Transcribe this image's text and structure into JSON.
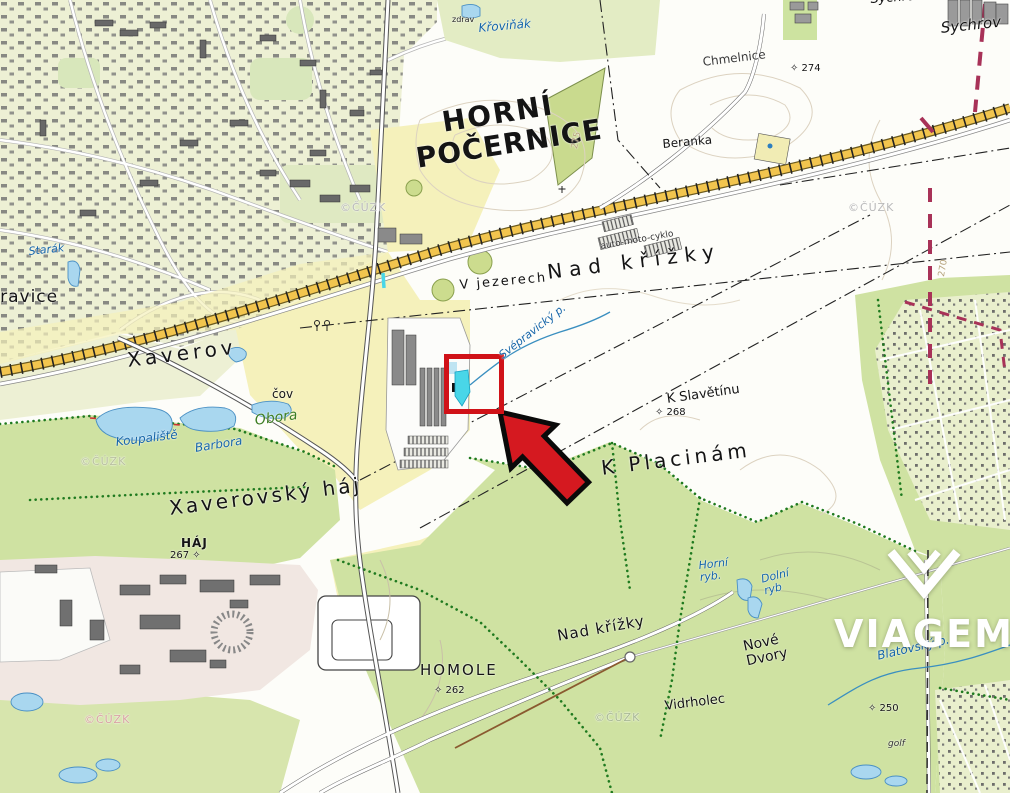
{
  "brand": {
    "watermark_text": "VIAGEM"
  },
  "colors": {
    "highlight_red": "#d01218",
    "arrow_red": "#d51920",
    "water": "#a9d7ef",
    "water_highlight": "#49d6e8",
    "forest": "#cfe2a2",
    "field": "#f5f1bb",
    "urban_base": "#edf0d4",
    "railway": "#f2c54e",
    "boundary_magenta": "#a83258",
    "label_blue": "#1565a8",
    "label_green": "#3c7d22",
    "watermark_gray": "#b9b9b9"
  },
  "map": {
    "labels": [
      {
        "id": "horni",
        "t": "HORNÍ",
        "x": 440,
        "y": 108,
        "fs": 28,
        "fw": 800,
        "ls": 2,
        "rot": -9
      },
      {
        "id": "pocernice",
        "t": "POČERNICE",
        "x": 414,
        "y": 144,
        "fs": 28,
        "fw": 800,
        "ls": 1,
        "rot": -9
      },
      {
        "id": "nad-krizky-north",
        "t": "Nad křížky",
        "x": 546,
        "y": 262,
        "fs": 20,
        "ls": 7,
        "rot": -7
      },
      {
        "id": "v-jezerech",
        "t": "V jezerech",
        "x": 459,
        "y": 279,
        "fs": 13,
        "ls": 2,
        "rot": -5
      },
      {
        "id": "auto-moto-cyklo",
        "t": "auto-moto-cyklo",
        "x": 600,
        "y": 243,
        "fs": 9,
        "rot": -10,
        "c": "#333333"
      },
      {
        "id": "svepravicky-potok",
        "t": "Svépravický p.",
        "x": 497,
        "y": 352,
        "fs": 11,
        "fst": "italic",
        "c": "#1565a8",
        "rot": -38
      },
      {
        "id": "xaverov",
        "t": "Xaverov",
        "x": 126,
        "y": 350,
        "fs": 20,
        "ls": 4,
        "rot": -7
      },
      {
        "id": "cov",
        "t": "čov",
        "x": 272,
        "y": 388,
        "fs": 12
      },
      {
        "id": "obora",
        "t": "Obora",
        "x": 254,
        "y": 414,
        "fs": 14,
        "fst": "italic",
        "c": "#3c7d22",
        "rot": -8
      },
      {
        "id": "koupaliste",
        "t": "Koupaliště",
        "x": 115,
        "y": 436,
        "fs": 12,
        "fst": "italic",
        "c": "#1565a8",
        "rot": -7
      },
      {
        "id": "barbora",
        "t": "Barbora",
        "x": 194,
        "y": 442,
        "fs": 12,
        "fst": "italic",
        "c": "#1565a8",
        "rot": -9
      },
      {
        "id": "xaverovsky-haj",
        "t": "Xaverovský háj",
        "x": 168,
        "y": 498,
        "fs": 20,
        "ls": 3,
        "rot": -7
      },
      {
        "id": "haj",
        "t": "HÁJ",
        "x": 181,
        "y": 537,
        "fs": 12,
        "fw": 700,
        "ls": 1
      },
      {
        "id": "haj-elevation",
        "t": "267 ✧",
        "x": 170,
        "y": 551,
        "fs": 10
      },
      {
        "id": "k-slavetinu",
        "t": "K Slavětínu",
        "x": 666,
        "y": 393,
        "fs": 13,
        "rot": -8
      },
      {
        "id": "slavetinu-elevation",
        "t": "✧ 268",
        "x": 655,
        "y": 408,
        "fs": 10
      },
      {
        "id": "k-placinam",
        "t": "K Placinám",
        "x": 600,
        "y": 458,
        "fs": 20,
        "ls": 4,
        "rot": -7
      },
      {
        "id": "nad-krizky-south",
        "t": "Nad křížky",
        "x": 556,
        "y": 628,
        "fs": 15,
        "ls": 1,
        "rot": -10
      },
      {
        "id": "homole",
        "t": "HOMOLE",
        "x": 420,
        "y": 662,
        "fs": 15,
        "ls": 2
      },
      {
        "id": "homole-elevation",
        "t": "✧ 262",
        "x": 434,
        "y": 686,
        "fs": 10
      },
      {
        "id": "nove-dvory",
        "t": "Nové\nDvory",
        "x": 742,
        "y": 640,
        "fs": 14,
        "rot": -12
      },
      {
        "id": "vidrholec",
        "t": "Vidrholec",
        "x": 664,
        "y": 700,
        "fs": 13,
        "rot": -7
      },
      {
        "id": "horni-rybnik",
        "t": "Horní\nryb.",
        "x": 698,
        "y": 560,
        "fs": 11,
        "fst": "italic",
        "c": "#1565a8",
        "rot": -6
      },
      {
        "id": "dolni-rybnik",
        "t": "Dolní\nryb",
        "x": 760,
        "y": 574,
        "fs": 11,
        "fst": "italic",
        "c": "#1565a8",
        "rot": -14
      },
      {
        "id": "blatovsky-potok",
        "t": "Blatovský p.",
        "x": 876,
        "y": 650,
        "fs": 12,
        "fst": "italic",
        "c": "#1565a8",
        "rot": -13
      },
      {
        "id": "elevation-250",
        "t": "✧ 250",
        "x": 868,
        "y": 704,
        "fs": 10
      },
      {
        "id": "golf",
        "t": "golf",
        "x": 888,
        "y": 740,
        "fs": 9,
        "fst": "italic",
        "c": "#333333"
      },
      {
        "id": "chmelnice",
        "t": "Chmelnice",
        "x": 702,
        "y": 56,
        "fs": 12,
        "rot": -7,
        "c": "#3a3a3a"
      },
      {
        "id": "elevation-274",
        "t": "✧ 274",
        "x": 790,
        "y": 64,
        "fs": 10
      },
      {
        "id": "beranka",
        "t": "Beranka",
        "x": 662,
        "y": 138,
        "fs": 12,
        "rot": -5
      },
      {
        "id": "sychrov-top",
        "t": "Sychrov",
        "x": 870,
        "y": -7,
        "fs": 13,
        "fst": "italic",
        "rot": -4
      },
      {
        "id": "sychrov",
        "t": "Sychrov",
        "x": 940,
        "y": 20,
        "fs": 15,
        "fst": "italic",
        "rot": -6
      },
      {
        "id": "krovinak",
        "t": "Křoviňák",
        "x": 478,
        "y": 22,
        "fs": 12,
        "fst": "italic",
        "c": "#1565a8",
        "rot": -5
      },
      {
        "id": "zdrav",
        "t": "zdrav",
        "x": 452,
        "y": 16,
        "fs": 8,
        "c": "#222222"
      },
      {
        "id": "starak",
        "t": "Starák",
        "x": 28,
        "y": 246,
        "fs": 11,
        "fst": "italic",
        "c": "#1565a8",
        "rot": -6
      },
      {
        "id": "svepravice",
        "t": "Svépravice",
        "x": -46,
        "y": 288,
        "fs": 17,
        "ls": 1
      },
      {
        "id": "cuzk-1",
        "t": "©ČÚZK",
        "x": 340,
        "y": 202,
        "fs": 11,
        "c": "#b9b9b9",
        "ls": 1
      },
      {
        "id": "cuzk-2",
        "t": "©ČÚZK",
        "x": 848,
        "y": 202,
        "fs": 11,
        "c": "#b9b9b9",
        "ls": 1
      },
      {
        "id": "cuzk-3",
        "t": "©ČÚZK",
        "x": 80,
        "y": 456,
        "fs": 11,
        "c": "#b9c0a0",
        "ls": 1
      },
      {
        "id": "cuzk-4",
        "t": "©ČÚZK",
        "x": 594,
        "y": 712,
        "fs": 11,
        "c": "#a8b894",
        "ls": 1
      },
      {
        "id": "cuzk-5",
        "t": "©ČÚZK",
        "x": 84,
        "y": 714,
        "fs": 11,
        "c": "#d9a3a3",
        "ls": 1
      },
      {
        "id": "contour-275",
        "t": "275",
        "x": 571,
        "y": 148,
        "fs": 9,
        "c": "#b5a27a",
        "rot": -78
      },
      {
        "id": "contour-270",
        "t": "270",
        "x": 938,
        "y": 276,
        "fs": 9,
        "c": "#b5a27a",
        "rot": -80
      }
    ]
  }
}
